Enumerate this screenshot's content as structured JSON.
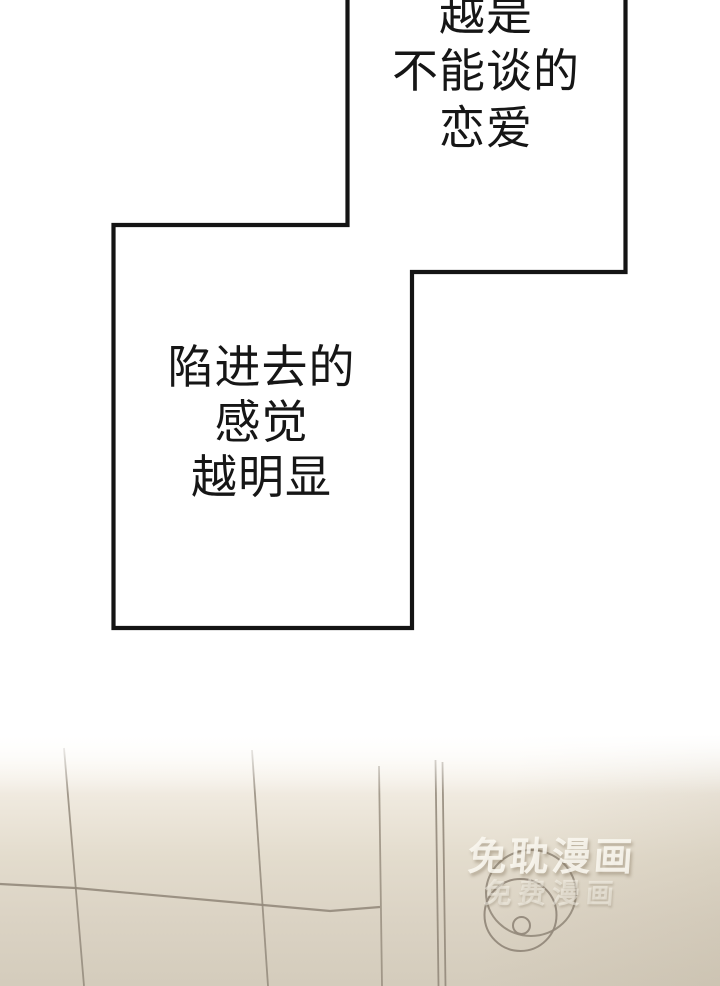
{
  "speech": {
    "top": {
      "lines": [
        "越是",
        "不能谈的",
        "恋爱"
      ]
    },
    "middle": {
      "lines": [
        "陷进去的",
        "感觉",
        "越明显"
      ]
    }
  },
  "watermark": {
    "primary": "免耽漫画",
    "secondary": "免费漫画"
  },
  "colors": {
    "panel_outline": "#141414",
    "speech_text": "#161616",
    "scene_line": "#93897b",
    "scene_base_beige": "#d5cdbe"
  }
}
